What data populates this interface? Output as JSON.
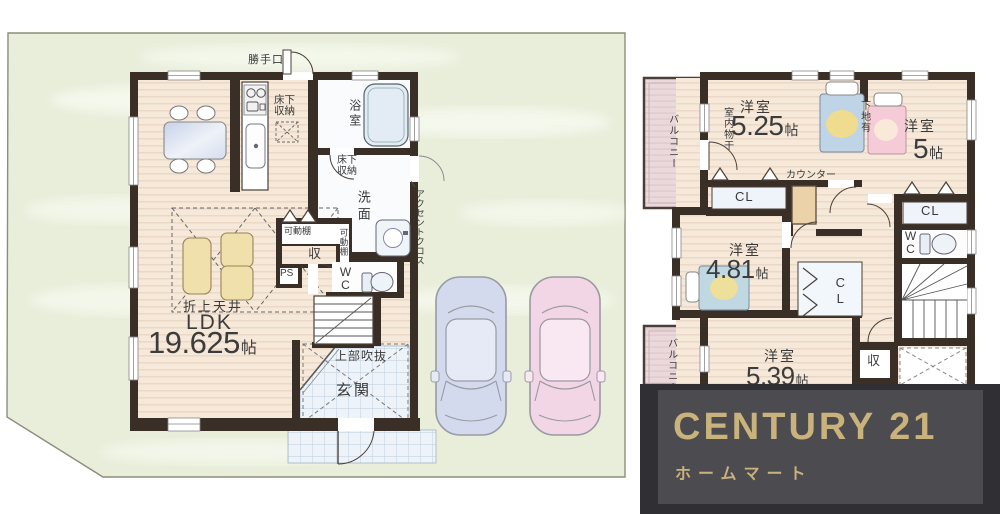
{
  "colors": {
    "site_green": "#e9eedb",
    "wall": "#3a2f27",
    "wood_floor": "#f6e9d9",
    "tile": "#eef3f9",
    "balcony": "#ead8da",
    "logo_frame": "#303034",
    "logo_panel": "#4b4b50",
    "logo_gold": "#c9b27c"
  },
  "left_plan": {
    "back_door": "勝手口",
    "underfloor_storage_kitchen": "床下収納",
    "bathroom": "浴室",
    "underfloor_storage_wash": "床下収納",
    "washroom": "洗面",
    "accent_cloth": "アクセントクロス",
    "movable_shelf_top": "可動棚",
    "movable_shelf_side": "可動棚",
    "storage": "収",
    "pipe_space": "PS",
    "toilet": "WC",
    "coffered_ceiling": "折上天井",
    "room_name": "LDK",
    "room_size": "19.625",
    "size_unit": "帖",
    "open_above": "上部吹抜",
    "entrance": "玄関"
  },
  "right_plan": {
    "balcony_top": "バルコニー",
    "indoor_drying": "室内物干",
    "room1_name": "洋室",
    "room1_size": "5.25",
    "room1_unit": "帖",
    "wall_backing": "下地有",
    "room2_name": "洋室",
    "room2_size": "5",
    "room2_unit": "帖",
    "counter": "カウンター",
    "closet1": "CL",
    "closet2": "CL",
    "closet3": "CL",
    "toilet": "WC",
    "room3_name": "洋室",
    "room3_size": "4.81",
    "room3_unit": "帖",
    "balcony_bottom": "バルコニー",
    "room4_name": "洋室",
    "room4_size": "5.39",
    "room4_unit": "帖",
    "storage": "収"
  },
  "logo": {
    "brand": "CENTURY 21",
    "company": "ホームマート"
  }
}
